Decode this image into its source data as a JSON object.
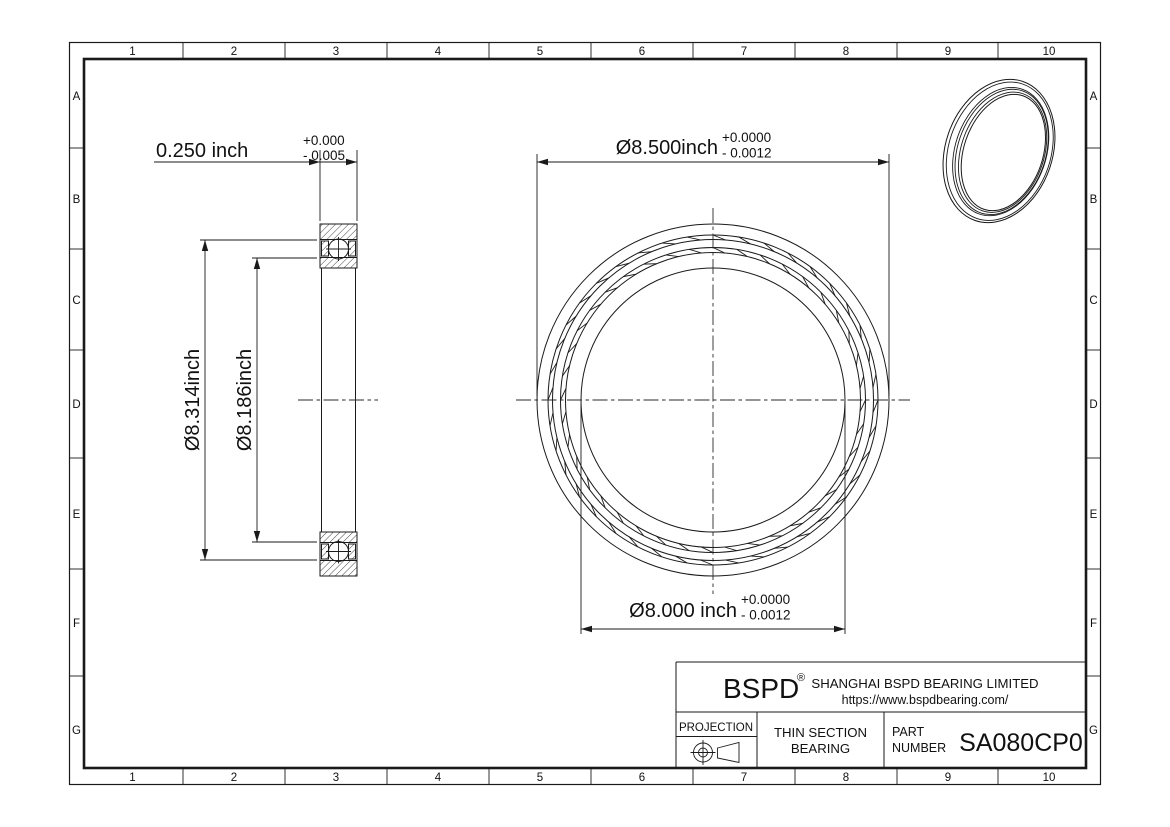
{
  "sheet": {
    "background": "#ffffff",
    "line_color": "#1a1a1a",
    "column_labels": [
      "1",
      "2",
      "3",
      "4",
      "5",
      "6",
      "7",
      "8",
      "9",
      "10"
    ],
    "row_labels": [
      "A",
      "B",
      "C",
      "D",
      "E",
      "F",
      "G"
    ]
  },
  "dimensions": {
    "width": {
      "nominal": "0.250 inch",
      "upper_tol": "+0.000",
      "lower_tol": "- 0.005"
    },
    "outer_diameter": {
      "nominal": "Ø8.500inch",
      "upper_tol": "+0.0000",
      "lower_tol": "- 0.0012"
    },
    "bore_diameter": {
      "nominal": "Ø8.000 inch",
      "upper_tol": "+0.0000",
      "lower_tol": "- 0.0012"
    },
    "outer_raceway_diameter": {
      "nominal": "Ø8.314inch"
    },
    "inner_raceway_diameter": {
      "nominal": "Ø8.186inch"
    }
  },
  "title_block": {
    "logo_text": "BSPD",
    "registered_mark": "®",
    "company_name": "SHANGHAI BSPD BEARING LIMITED",
    "website": "https://www.bspdbearing.com/",
    "projection_label": "PROJECTION",
    "product_type_line1": "THIN SECTION",
    "product_type_line2": "BEARING",
    "part_number_label_line1": "PART",
    "part_number_label_line2": "NUMBER",
    "part_number": "SA080CP0"
  }
}
